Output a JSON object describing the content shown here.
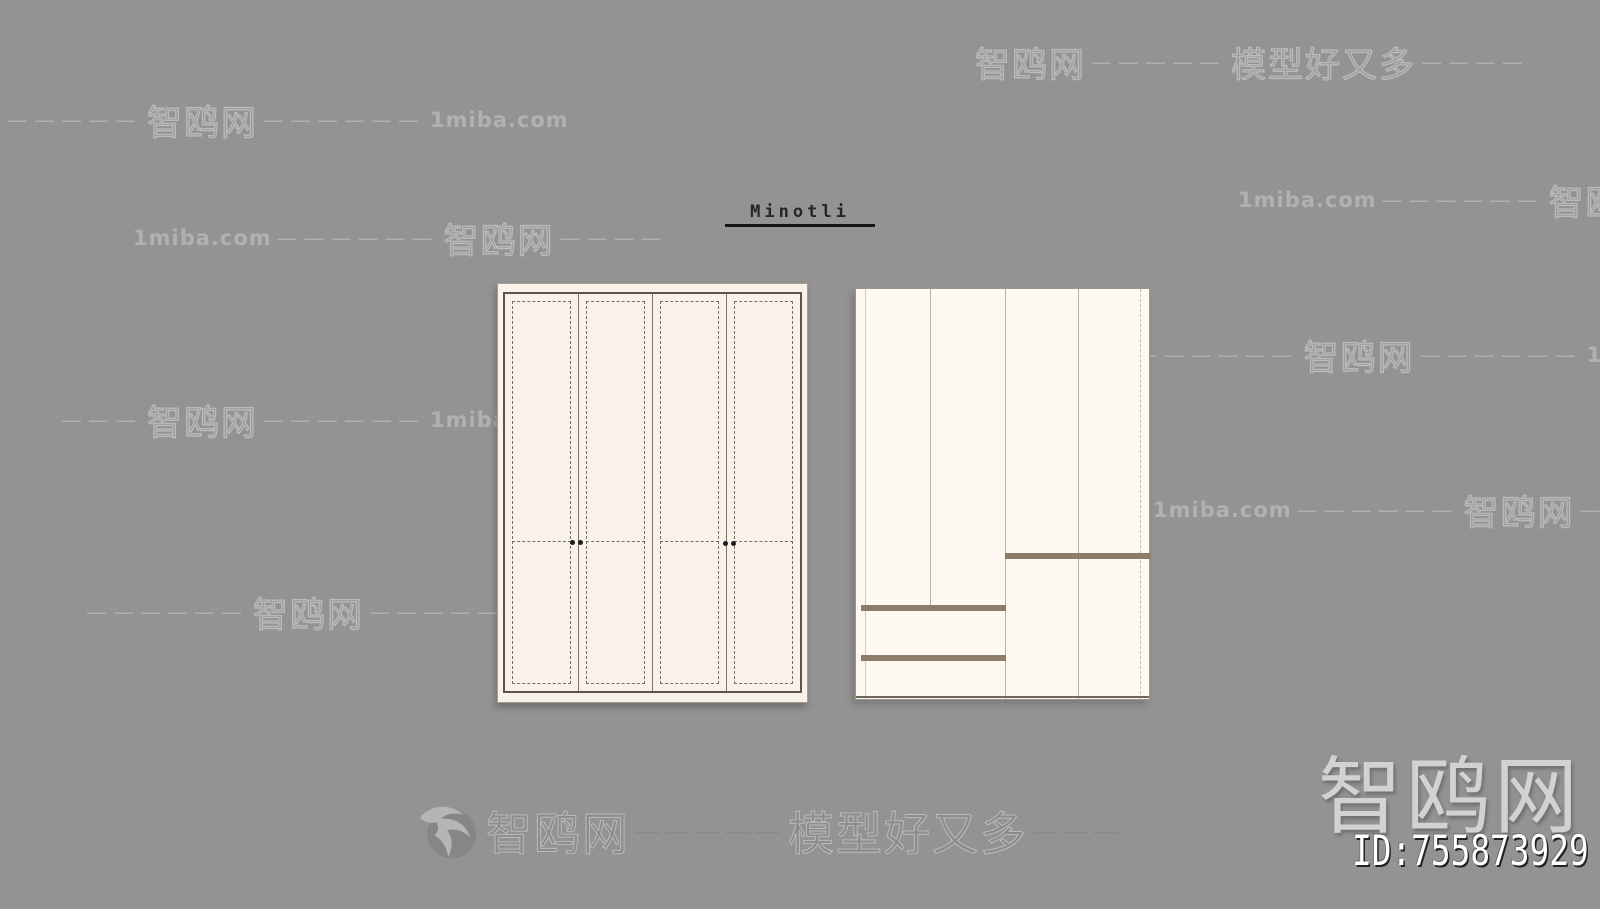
{
  "brand": {
    "label": "Minotli"
  },
  "watermark": {
    "site_name": "智鸥网",
    "slogan": "模型好又多",
    "domain": "1miba.com",
    "rows": [
      {
        "seg1": "智鸥网",
        "seg2": "—————",
        "seg3": "模型好又多",
        "seg4": "————"
      },
      {
        "seg1": "—————",
        "seg2": "智鸥网",
        "seg3": "——————",
        "seg4": "1miba.com"
      },
      {
        "seg1": "1miba.com",
        "seg2": "——————",
        "seg3": "智鸥网",
        "seg4": "—"
      },
      {
        "seg1": "1miba.com",
        "seg2": "——————",
        "seg3": "智鸥网",
        "seg4": "————"
      },
      {
        "seg1": "1miba.com",
        "seg2": "——————",
        "seg3": "智鸥网",
        "seg4": "——————",
        "seg5": "1miba.com"
      },
      {
        "seg1": "———",
        "seg2": "智鸥网",
        "seg3": "——————",
        "seg4": "1miba.com"
      },
      {
        "seg1": "1miba.com",
        "seg2": "——————",
        "seg3": "智鸥网",
        "seg4": "—————"
      },
      {
        "seg1": "——————",
        "seg2": "智鸥网",
        "seg3": "——————",
        "seg4": "1miba.com"
      }
    ],
    "footer": {
      "site": "智鸥网",
      "dash1": "—————",
      "slogan": "模型好又多",
      "dash2": "———"
    },
    "corner": {
      "site": "智鸥网",
      "model_id": "ID:755873929"
    }
  },
  "icons": {
    "logo": "seagull-logo-icon"
  },
  "colors": {
    "background": "#939393",
    "cabinet_fill_left": "#f9f2e8",
    "cabinet_fill_right": "#fdf8f0",
    "sketch_line": "#5c554c",
    "drawer_divider": "#8c7c6a",
    "watermark_gray": "#c0c0c0",
    "site_name_large": "#d2d2d2",
    "id_text": "#ffffff"
  }
}
